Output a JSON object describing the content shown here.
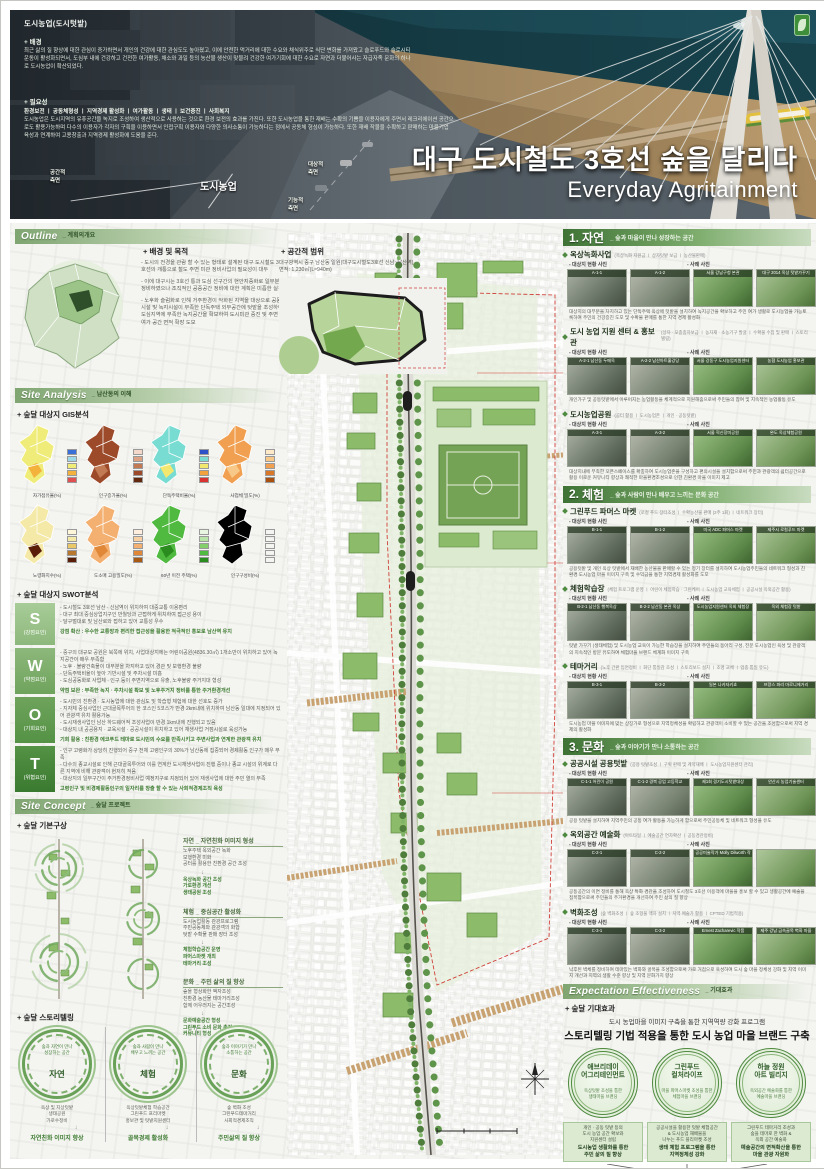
{
  "header": {
    "overlay": {
      "title": "도시농업(도시텃밭)",
      "background_label": "+ 배경",
      "background_text": "최근 삶의 질 향상에 대한 관심이 증가하면서 개인의 건강에 대한 관심도도 높아졌고, 이에 안전한 먹거리에 대한 수요와 채식위주로 식단 변화를 가져왔고 슬로푸드와 슬로시티 운동이 활성화되면서, 도심부 내에 건강하고 건전한 여가활동, 채소와 과일 등의 농산물 생산이 맞물려 건강한 여가기회에 대한 수요로 자연과 더불어사는 자급자족 문화의 하나로 도시농업이 확산되었다.",
      "necessity_label": "+ 필요성",
      "necessity_keywords": "환경보전 ㅣ 공동체형성 ㅣ 지역경제 활성화 ㅣ 여가활동 ㅣ 생태 ㅣ 보건증진 ㅣ 사회복지",
      "necessity_text": "도시농업은 도시지역의 유휴공간을 녹지로 조성하여 생산적으로 사용하는 것으로 환경 보전의 효과를 가진다. 또한 도시농업을 통한 재배는 수확의 기쁨을 이용자에게 주면서 레크리에이션 공간으로도 활용가능하며 다수의 이용자가 각자의 구획을 이용하면서 인접구획 이용자와 다양한 의사소통이 가능하다는 점에서 공동체 형성이 가능하다. 또한 재배 작물을 수확하고 판매하는 마을기업 육성과 연계하여 고용창출과 지역경제 활성화에 도움을 준다.",
      "diagram": {
        "center": "도시농업",
        "left": "공간적\n측면",
        "right_top": "대상적\n측면",
        "right_bottom": "기능적\n측면"
      }
    },
    "title_ko": "대구 도시철도 3호선 숲을 달리다",
    "title_en": "Everyday Agritainment"
  },
  "left": {
    "outline": {
      "heading": "Outline",
      "heading_sub": "_ 계획의개요",
      "purpose_label": "+ 배경 및 목적",
      "purpose_items": [
        "- 도시의 전경을 관람 할 수 있는 형태로 설계된 대구 도시철도 3호선의 개통으로 철도 주변 미관 정비사업의 필요성이 대두",
        "- 이에 대구시는 3호선 통과 도심 선구간의 현안지중화로 일부분 정비하였으나 조직적인 공중공간 정비에 대한 계획은 미흡한 실정",
        "- 노후화 슬럼화로 인해 거주환경이 악화된 지역을 대상으로 공동시설 및 녹지시설이 부족한 단독주택 외부공간에 텃밭을 조성하여 도심지역에 부족한 녹지공간을 확보하여 도시미관 증진 및 주변 여가 공간 면적 확장 도모"
      ],
      "scope_label": "+ 공간적 범위",
      "scope_line1": "대구광역시 중구 남산동 일원(대구도시철도3호선 신남~남산역)",
      "scope_line2": "면적: 1,230㎡(L≈940m)"
    },
    "site_analysis": {
      "heading": "Site Analysis",
      "heading_sub": "_ 남산동의 이해",
      "gis_label": "+ 숲달 대상지 GIS분석",
      "gis_maps": [
        {
          "name": "자가점유율(%)",
          "palette": "#a0522d"
        },
        {
          "name": "인구증가율(%)",
          "palette": "#f0ec7a"
        },
        {
          "name": "단독주택비율(%)",
          "palette": "#9c4a2a"
        },
        {
          "name": "사업체 밀도(%)",
          "palette": "#79dcd2"
        },
        {
          "name": "노령화지수(%)",
          "palette": "#f0a050"
        },
        {
          "name": "도소매 고용밀도(%)",
          "palette": "#f5e9a8"
        },
        {
          "name": "60년 이전 주택(%)",
          "palette": "#f3b070"
        },
        {
          "name": "인구구성비(%)",
          "palette": "#4fba3f"
        }
      ],
      "swot_label": "+ 숲달 대상지 SWOT분석",
      "swot": [
        {
          "letter": "S",
          "label": "(강점요인)",
          "items": [
            "- 도시철도 3호선 남산 · 신남역이 위치하여 대중교통 이용편리",
            "- 대구 최대 중심상업지구인 반월당과 근접하게 위치하여 접근성 용이",
            "- 달구벌대로 및 남산로와 접하고 있어 교통성 우수",
            ""
          ],
          "summary": "강점 확산 : 우수한 교통망과 편리한 접근성을 활용한 적극적인 홍보로 남산역 유치"
        },
        {
          "letter": "W",
          "label": "(약점요인)",
          "items": [
            "- 중구의 대규모 공원은 북쪽에 위치, 사업대상지에는 어린이공원(4836.30㎡) 1개소만이 위치하고 있어 녹지공간이 매우 부족함",
            "- 노후 · 불량건축물이 대부분을 차지하고 있어 경관 및 보행환경 불량",
            "- 단독주택비율이 높아 기반시설 및 주차시설 미흡",
            "- 도심공동화로 사업체 · 인구 등이 주변지역으로 유출, 노후불량 주거지대 형성"
          ],
          "summary": "약점 보완 : 부족한 녹지 · 주차시설 확보 및 노후주거지 정비를 통한 주거환경개선"
        },
        {
          "letter": "O",
          "label": "(기회요인)",
          "items": [
            "- 도시민의 친환경 · 도시농업에 대한 관심도 및 학습형 체험에 대한 선호도 증가",
            "- 지자체 중심사업인 근대골목투어의 한 코스인 5코스가 반경 2km내에 위치하여 남산동 일대에 지정되어 있어 관광객 유치 활용가능",
            "- 도시재생사업인 남산 하드웨어적 조성사업이 반경 1km내에 진행되고 있음",
            "- 대상지 내 공공용지 · 교육시설 · 공공시설이 위치하고 있어 재생사업 거점시설로 육성가능"
          ],
          "summary": "기회 활용 : 친환경 에코푸드 테마로 도시민의 수요를 만족시키고 주변사업과 연계한 관광객 유치"
        },
        {
          "letter": "T",
          "label": "(위협요인)",
          "items": [
            "- 인구 고령화가 상당히 진행되어 중구 전체 고령인구의 30%가 남산동에 집중되어 경제활동 인구가 매우 부족",
            "- 다수의 종교시설로 인해 근대골목투어와 이를 연계한 도시재생사업이 진행 중이나 종교 시설의 위계로 다른 지역에 비해 관광객이 현저히 적음",
            "- 대상지의 일부구간이 주거환경정비사업 예정지구로 지정되어 있어 재생사업에 대한 주민 열의 부족",
            ""
          ],
          "summary": "고령인구 및 비경제활동인구의 일자리를 창출 할 수 있는 사회적경제조직 육성"
        }
      ]
    },
    "site_concept": {
      "heading": "Site Concept",
      "heading_sub": "_ 숲달 프로젝트",
      "concept_label": "+ 숲달 기본구상",
      "concepts": [
        {
          "title": "자연 _ 자연친화 이미지 형성",
          "items": "노후주택 옥외공간 녹화\n보행환경 미화\n공터를 활용한 친환경 공간 조성",
          "results": "옥상녹화 공간 조성\n가로환경 개선\n생태공원 조성"
        },
        {
          "title": "체험 _ 중심공간 활성화",
          "items": "도시농업활동 관광프로그램\n주민공동체와 관광객의 화합\n텃밭 수확물 판매 장터 조성",
          "results": "체험학습공간 운영\n파머스마켓 개최\n테마거리 조성"
        },
        {
          "title": "문화 _ 주민 삶의 질 향상",
          "items": "숲을 형상화한 액자조성\n친환경 농산물 테마거리조성\n함께 어우러지는 공간조성",
          "results": "문화예술공간 형성\n그린푸드 소비 문화 촉진\n커뮤니티 형성"
        }
      ]
    },
    "storytelling": {
      "label": "+ 숲달 스토리텔링",
      "circles": [
        {
          "tagline": "숲과 자연이 만나\n성장하는 공간",
          "name": "자연",
          "items": "옥상 및 지상텃밭\n생태공원\n가로수정비",
          "result": "자연친화 이미지 향상"
        },
        {
          "tagline": "숲과 사람이 만나\n배우고 느끼는 공간",
          "name": "체험",
          "items": "옥상텃밭체험 학습공간\n그린푸드 프리마켓\n홍보관 및 텃밭지원센터",
          "result": "골목경제 활성화"
        },
        {
          "tagline": "숲과 이야기가 만나\n소통하는 공간",
          "name": "문화",
          "items": "숲 벽화 조성\n그린푸드테마거리\n사회적경제조직",
          "result": "주민삶의 질 향상"
        }
      ]
    }
  },
  "right": {
    "sections": [
      {
        "no": "1.",
        "name": "자연",
        "tagline": "_ 숲과 마을이 만나 성장하는 공간",
        "subs": [
          {
            "title": "옥상녹화사업",
            "keywords": "(옥상녹화 지원금 ㅣ 상자텃밭 보급 ㅣ 농산물판매)",
            "site_label": "- 대상지 현황 사진",
            "case_label": "- 사례 사진",
            "photos": [
              {
                "cap": "A-1-1"
              },
              {
                "cap": "A-1-2"
              },
              {
                "cap": "서울 강남구청 본관"
              },
              {
                "cap": "대구 2014 옥상 텃밭가꾸기"
              }
            ],
            "caption": "대상지의 대부분을 차지하고 있는 단독주택 옥상에 텃밭을 설치하여 녹지공간을 확보하고 주민 여가 생활로 도시농업을 가능토록하여 주민의 건강증진 도모 및 수확물 판매를 통한 지역 경제 활성화"
          },
          {
            "title": "도시 농업 지원 센터 & 홍보관",
            "keywords": "(상자 · 모종종자보급 ㅣ 농자재 · 소농기구 발굴 ㅣ 수확물 수집 및 판매 ㅣ 스토리텔링)",
            "site_label": "- 대상지 현황 사진",
            "case_label": "- 사례 사진",
            "photos": [
              {
                "cap": "A-2-1 남산동 두메옥"
              },
              {
                "cap": "A-2-2 남산아트홀강당"
              },
              {
                "cap": "서울 강동구 도시농업지원센터"
              },
              {
                "cap": "농협 도시농업 홍보관"
              }
            ],
            "caption": "개인가구 및 공동텃밭에서 이루어지는 농업활동을 체계적으로 지원해줌으로써 주민들의 참여 및 지속적인 농업활동 유도"
          },
          {
            "title": "도시농업공원",
            "keywords": "(공터 활용 ㅣ 도시농업존 ㅣ 개인 · 공동텃밭)",
            "site_label": "- 대상지 현황 사진",
            "case_label": "- 사례 사진",
            "photos": [
              {
                "cap": "A-3-1"
              },
              {
                "cap": "A-3-2"
              },
              {
                "cap": "서울 혁신장미공원"
              },
              {
                "cap": "완도 옥상체험공원"
              }
            ],
            "caption": "대상지내에 부족한 오픈스페이스를 확충하여 도시농업존을 구성하고 편의시설을 설치함으로써 주민과 관광객의 쉼터공간으로 활용 이로운 커뮤니티 향상과 쾌적한 마을환경조성으로 인한 친환경 마을 이미지 제고"
          }
        ]
      },
      {
        "no": "2.",
        "name": "체험",
        "tagline": "_ 숲과 사람이 만나 배우고 느끼는 문화 공간",
        "subs": [
          {
            "title": "그린푸드 파머스 마켓",
            "keywords": "(로컬 푸드 장터조성 ㅣ 수확농산물 판매 (2주 1회) ㅣ 네트워크 장터)",
            "site_label": "- 대상지 현황 사진",
            "case_label": "- 사례 사진",
            "photos": [
              {
                "cap": "B-1-1"
              },
              {
                "cap": "B-1-2"
              },
              {
                "cap": "미국 ADC 파머스 마켓"
              },
              {
                "cap": "제주시 로컬푸드 마켓"
              }
            ],
            "caption": "공용텃밭 및 개인 옥상 텃밭에서 재배한 농산물을 판매할 수 있는 정기 장터를 설치하여 도시농업주민들의 네트워크 형성과 친환경 도시농업 마을 이미지 구축 및 수익금을 통한 지역경제 활성화를 도모"
          },
          {
            "title": "체험학습장",
            "keywords": "(체험 프로그램 운영 ㅣ 어린이 체험학습 · 그린케어 ㅣ 도시농업 교육체험 ㅣ 공공시설 옥외공간 활용)",
            "site_label": "- 대상지 현황 사진",
            "case_label": "- 사례 사진",
            "photos": [
              {
                "cap": "B-2-1 남산동 행복옥상"
              },
              {
                "cap": "B-2-2 남산동 본관 옥상"
              },
              {
                "cap": "도시농업지원센터 옥외 체험장"
              },
              {
                "cap": "옥외 체험장 텃밭"
              }
            ],
            "caption": "텃밭 가꾸기 (생태체험) 및 도시농업 교육이 가능한 학습장을 설치하여 주민들의 동아리 구성, 전문 도시농업인 육성 및 관광객의 지속적인 방문 유도하여 체험마을 브랜드 체계화 이미지 구축"
          },
          {
            "title": "테마거리",
            "keywords": "(노후 간판 입면정비 ㅣ 화단 통일감 조성 ㅣ 스토리보드 설치 ㅣ 조명 교체 ㅣ 업종 통일 유도)",
            "site_label": "- 대상지 현황 사진",
            "case_label": "- 사례 사진",
            "photos": [
              {
                "cap": "B-3-1"
              },
              {
                "cap": "B-3-2"
              },
              {
                "cap": "일본 나카자키쵸"
              },
              {
                "cap": "프랑스 파리 마로니에거리"
              }
            ],
            "caption": "도시농업 마을 이미지에 맞는 상징가로 형성으로 지역정체성을 확립하고 관광객이 소비할 수 있는 공간을 조성함으로써 지역 경제의 활성화"
          }
        ]
      },
      {
        "no": "3.",
        "name": "문화",
        "tagline": "_ 숲과 이야기가 만나 소통하는 공간",
        "subs": [
          {
            "title": "공공시설 공용텃밭",
            "keywords": "(공용 텃밭조성 ㅣ 구획 판매 및 계약재배 ㅣ 도시농업지원센터 관리)",
            "site_label": "- 대상지 현황 사진",
            "case_label": "- 사례 사진",
            "photos": [
              {
                "cap": "C-1-1 어린이 공원"
              },
              {
                "cap": "C-1-2 경북 공업 고등학교"
              },
              {
                "cap": "제1회 경기도시텃밭대상"
              },
              {
                "cap": "안산시 농업기술센터"
              }
            ],
            "caption": "공용 텃밭을 설치하여 지역주민의 공동 여가 활동을 가능하게 함으로써 주민공동체 및 네트워크 형성을 유도"
          },
          {
            "title": "옥외공간 예술화",
            "keywords": "(아트타일 ㅣ 예술공간 연차확산 ㅣ 공동경관정비)",
            "site_label": "- 대상지 현황 사진",
            "case_label": "- 사례 사진",
            "photos": [
              {
                "cap": "C-2-1"
              },
              {
                "cap": "C-2-2"
              },
              {
                "cap": "공공미술작가 Molly Dilworth 작품"
              },
              {
                "cap": ""
              }
            ],
            "caption": "공동공간의 이면 정비를 통해 옥상 특화 경관을 조성하여 도시철도 3호선 이용객에 마을을 홍보 할 수 있고 생활공간에 예술을 접목함으로써 주민들의 주거환경을 개선하여 주민 삶의 질 향상"
          },
          {
            "title": "벽화조성",
            "keywords": "(숲 벽화조성 ㅣ 숲 조형물 액자 설치 ㅣ 지역 예술가 활용 ㅣ CPTED 기법적용)",
            "site_label": "- 대상지 현황 사진",
            "case_label": "- 사례 사진",
            "photos": [
              {
                "cap": "C-3-1"
              },
              {
                "cap": "C-3-2"
              },
              {
                "cap": "Ernest Zacharevic 작품"
              },
              {
                "cap": "제주 강남 금속골목 벽화 마을"
              }
            ],
            "caption": "낙후된 벽체를 정비하여 테마있는 벽화와 골목을 조성함으로써 가로 거점으로 육성하여 도시 숲 마을 정체성 강화 및 지역 이미지 개선과 지역의 생활 수준 향상 및 지역 문화가치 향상"
          }
        ]
      }
    ]
  },
  "expectation": {
    "heading": "Expectation Effectiveness",
    "heading_sub": "_ 기대효과",
    "label": "+ 숲달 기대효과",
    "line1": "도시 농업마을 이미지 구축을 통한 지역역량 강화 프로그램",
    "line2": "스토리텔링 기법 적용을 통한 도시 농업 마을 브랜드 구축",
    "circles": [
      {
        "name": "애브리데이\n어그리테인먼트",
        "sub": "옥상텃밭 조성을 통한\n생태마을 브랜딩",
        "detail": "개인 · 공동 텃밭 등의\n도시 농업 공간 확보와\n지원센터 설립",
        "result": "도시농업 생활화를 통한\n주민 삶의 질 향상"
      },
      {
        "name": "그린푸드\n컬처라이프",
        "sub": "마을 파머스마켓 조성을 통한\n체험마을 브랜딩",
        "detail": "공공시설을 활용한 텃밭 체험공간\n& 도시농업 재배물을\n나누는 푸드 플리마켓 조성",
        "result": "생태 체험 프로그램을 통한\n지역정체성 강화"
      },
      {
        "name": "하늘 정원\n아트 빌리지",
        "sub": "옥외공간 예술화를 통한\n예술마을 브랜딩",
        "detail": "그린푸드 테마거리 조성과\n숲을 테마로 한 벽화 &\n옥외 공간 예술화",
        "result": "예술공간의 면적확산을 통한\n마을 관광 자원화"
      }
    ],
    "conclusion": "지역 자원을 활용한 테마 마을 조성을 통한\n지역 커뮤니티 및 지역 경제 활성화"
  },
  "colors": {
    "accent_green": "#4e8a3f",
    "strip_green": "#7fa571",
    "dark_green": "#2f5d28",
    "swot_s": "#9dc48e",
    "swot_w": "#7fae6f",
    "swot_o": "#5f9a50",
    "swot_t": "#3f7d33",
    "map_red": "#c0392b",
    "train_yellow": "#e8c53f"
  }
}
